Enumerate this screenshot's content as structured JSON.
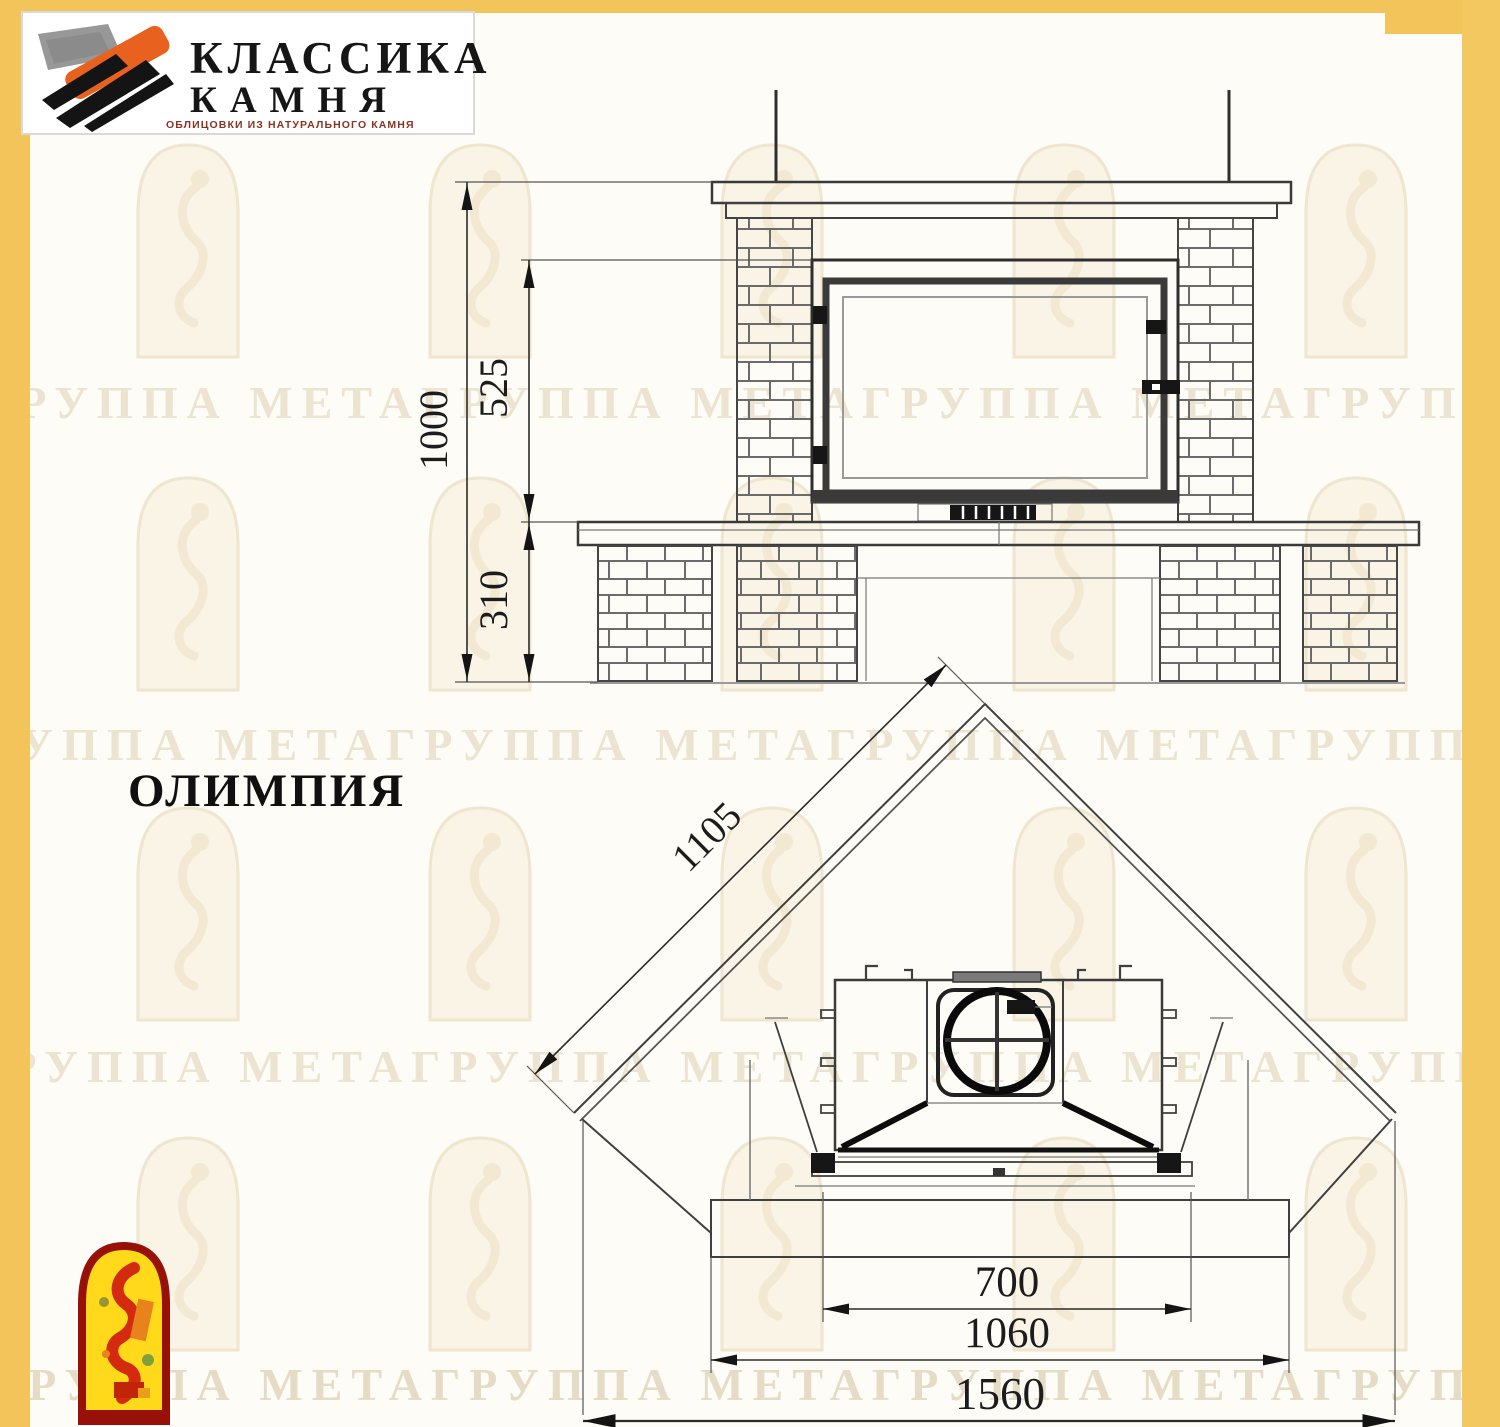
{
  "page": {
    "background": "#FDFCF6",
    "frame_color": "#F2C45A"
  },
  "header_logo": {
    "line1": "КЛАССИКА",
    "line2": "КАМНЯ",
    "tagline": "ОБЛИЦОВКИ ИЗ НАТУРАЛЬНОГО КАМНЯ",
    "accent_orange": "#E8611F"
  },
  "model": {
    "name": "ОЛИМПИЯ"
  },
  "watermark": {
    "row_text": "ГРУППА МЕТАГРУППА МЕТАГРУППА МЕТАГРУППА МЕТАГРУППА МЕТА"
  },
  "front_view": {
    "dim_total_height": "1000",
    "dim_opening_height": "525",
    "dim_bench_height": "310"
  },
  "plan_view": {
    "dim_back_side": "1105",
    "dim_opening_width": "700",
    "dim_body_width": "1060",
    "dim_overall_width": "1560"
  }
}
